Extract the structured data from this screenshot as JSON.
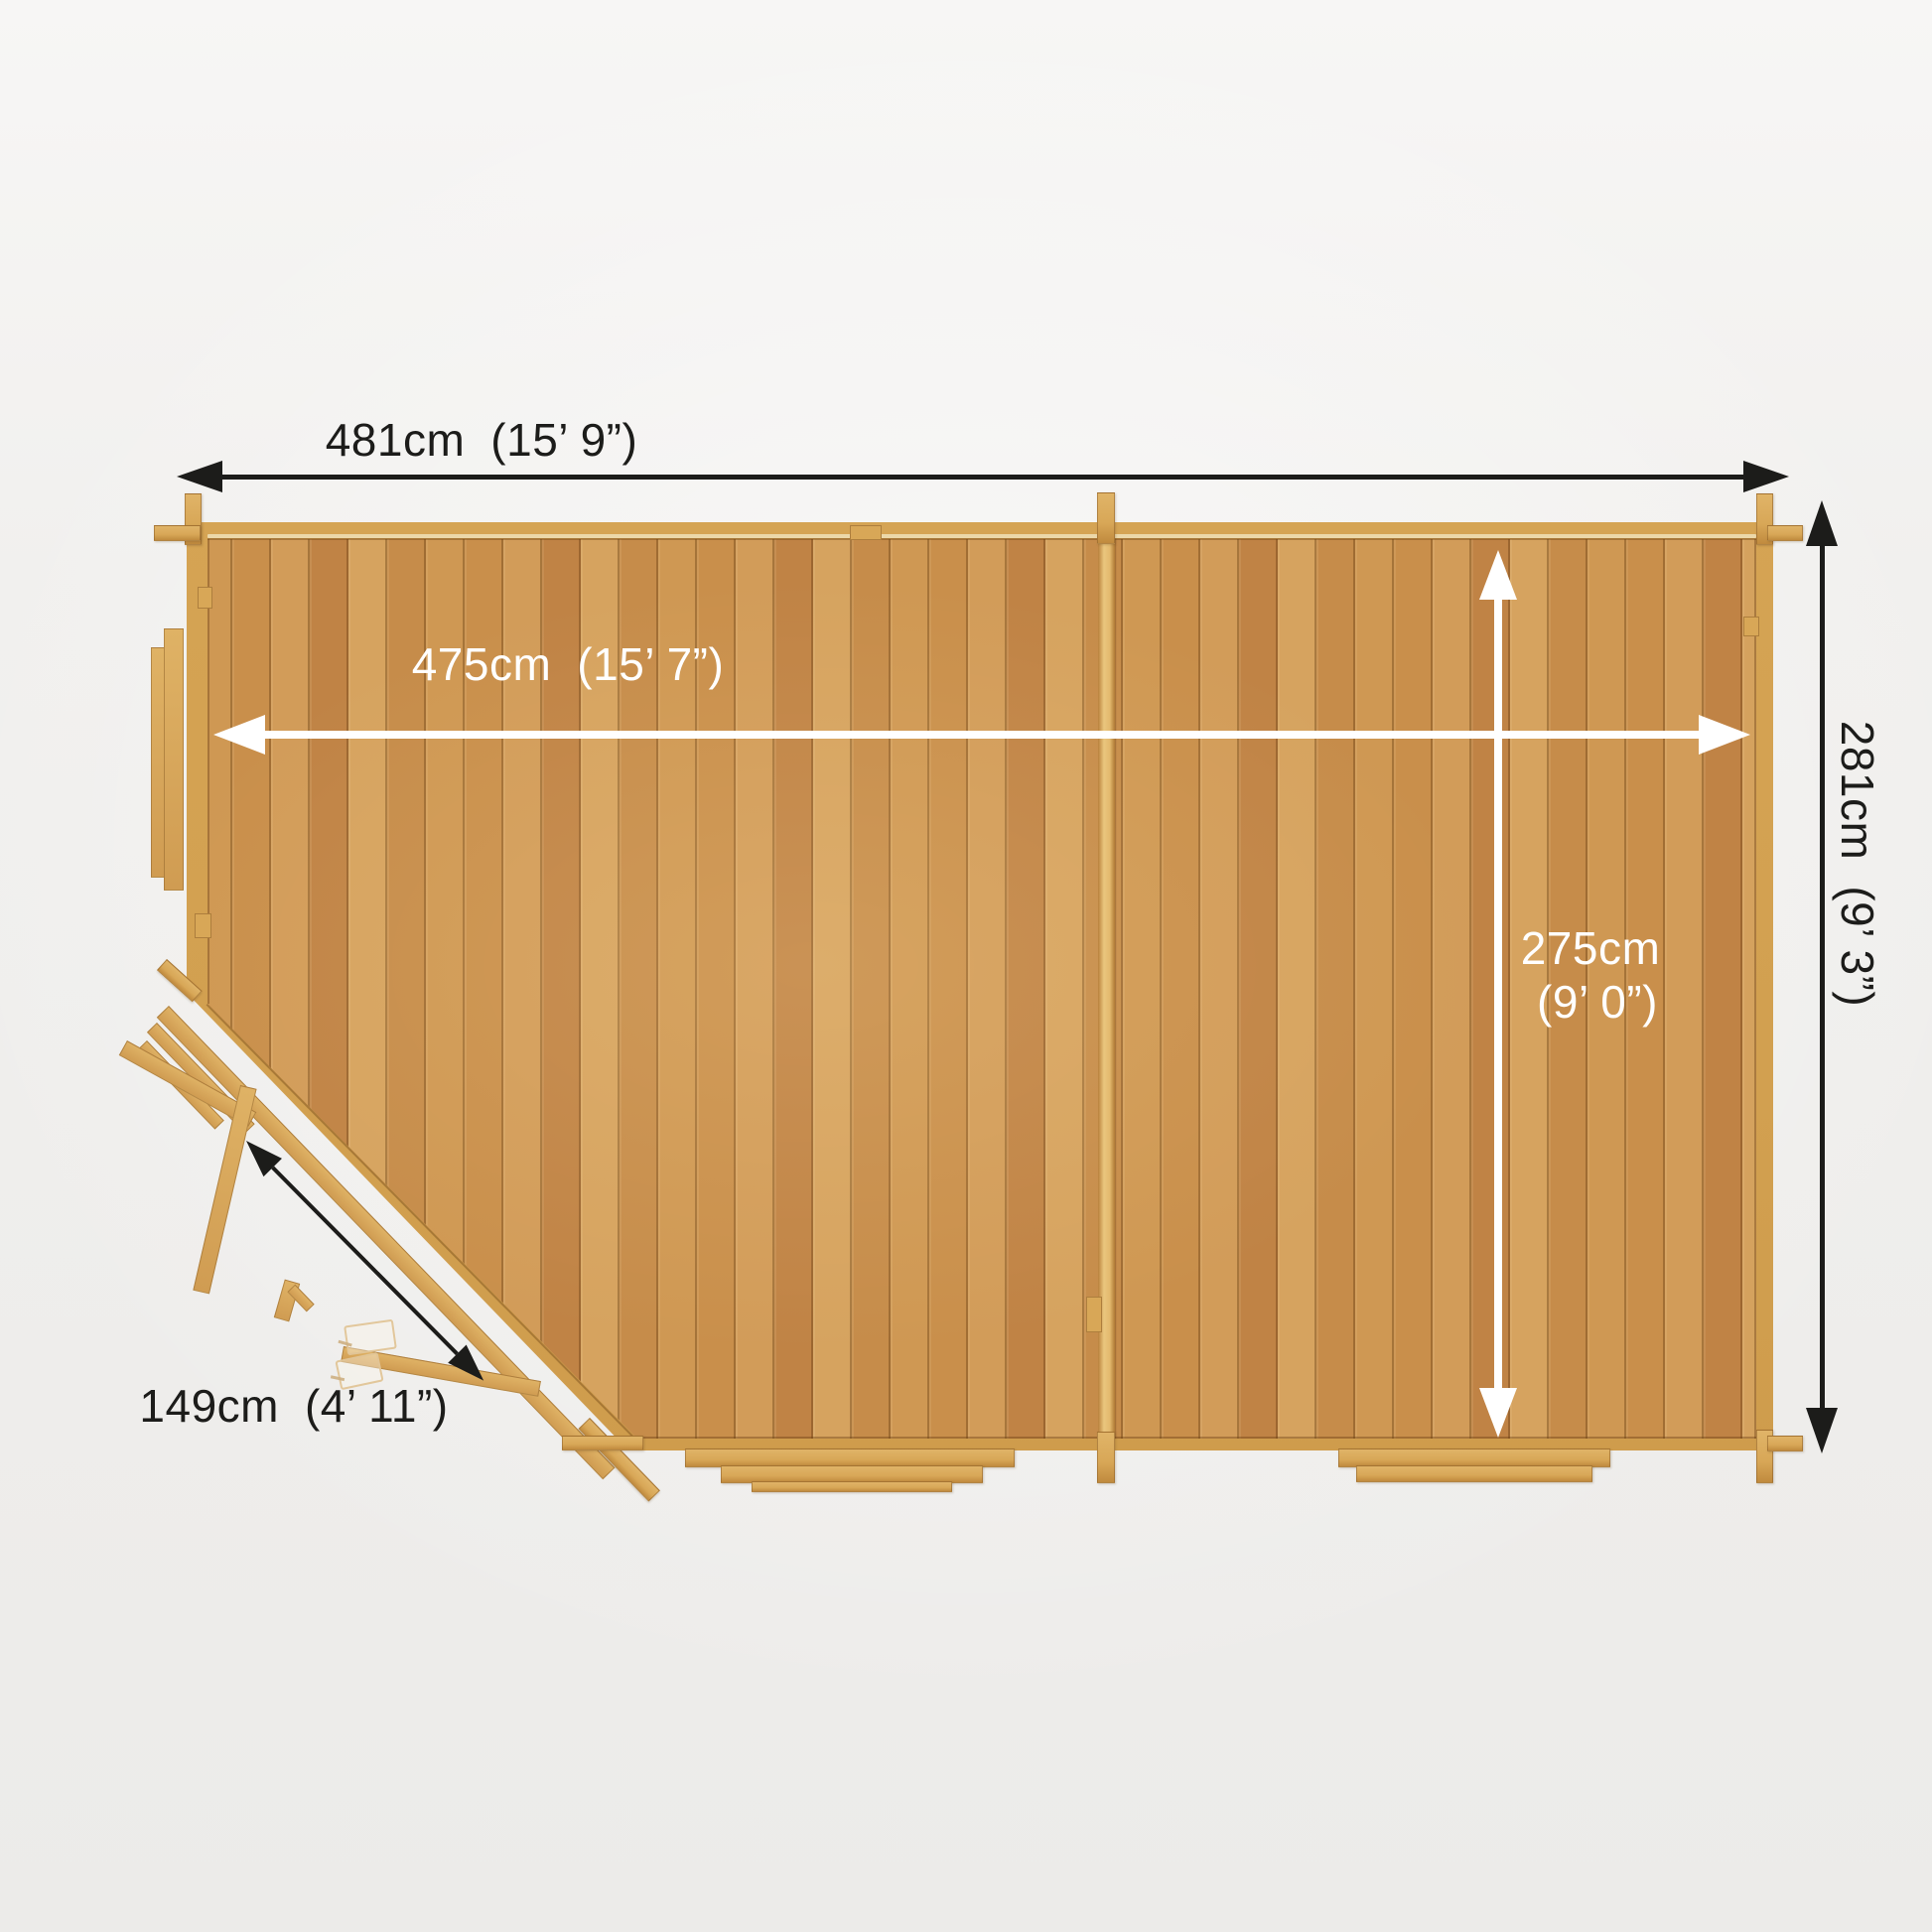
{
  "palette": {
    "background": "#f1f0ee",
    "wood_wall": "#d8a757",
    "wood_wall_edge": "#a9762f",
    "wood_light_line": "#f0e2b8",
    "floor_a": "#c98f4b",
    "floor_b": "#d29c59",
    "floor_c": "#c08345",
    "floor_d": "#d6a35f",
    "floor_seam": "rgba(96,56,14,0.38)",
    "partition": "#eac67e",
    "arrow_dark": "#1c1c1a",
    "arrow_light": "#ffffff",
    "label_dark": "#1c1c1a",
    "label_light": "#ffffff"
  },
  "dimensions": {
    "overall_width": {
      "metric": "481cm",
      "imperial": "(15’ 9”)"
    },
    "overall_depth": {
      "metric": "281cm",
      "imperial": "(9’ 3”)"
    },
    "internal_width": {
      "metric": "475cm",
      "imperial": "(15’ 7”)"
    },
    "internal_depth": {
      "metric": "275cm",
      "imperial": "(9’ 0”)"
    },
    "door_width": {
      "metric": "149cm",
      "imperial": "(4’ 11”)"
    }
  }
}
